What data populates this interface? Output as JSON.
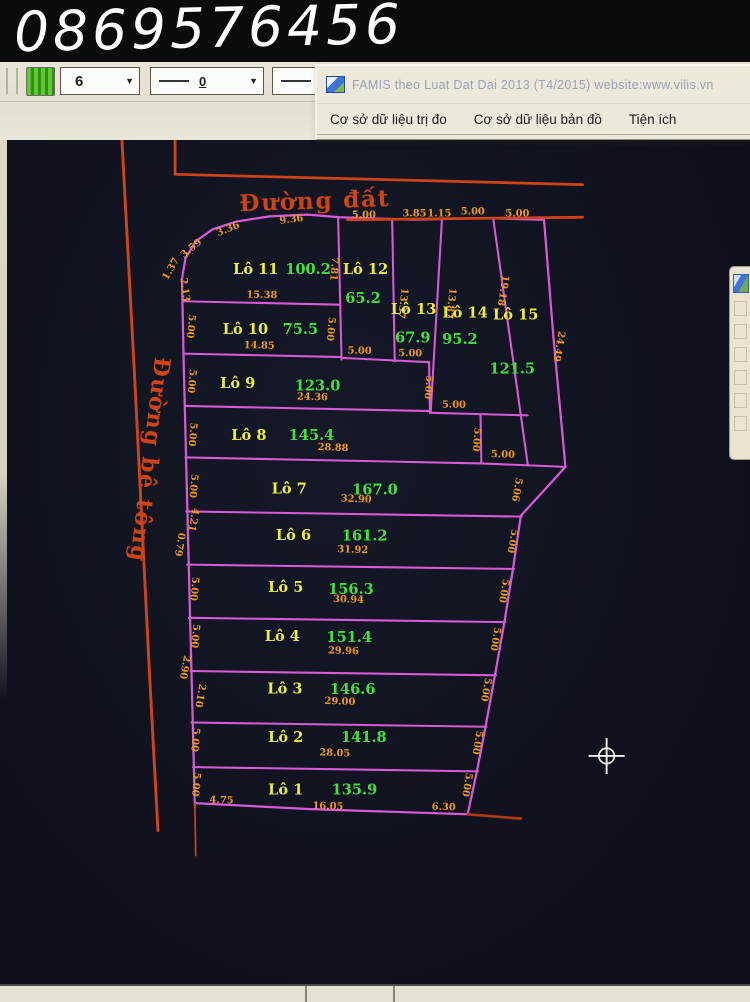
{
  "overlay": {
    "phone": "0869576456"
  },
  "toolbar": {
    "layer_value": "6",
    "line1_value": "0",
    "line2_value": "0",
    "dropdown_arrow": "▼",
    "info_icon_glyph": "i"
  },
  "famis": {
    "title": "FAMIS theo Luat Dat Dai 2013 (T4/2015)   website:www.vilis.vn",
    "menus": [
      "Cơ sở dữ liệu trị đo",
      "Cơ sở dữ liệu bản đồ",
      "Tiện ích"
    ]
  },
  "colors": {
    "magenta": "#d85ad8",
    "road": "#cf4417",
    "road_dark": "#b03a12",
    "dim": "#ef9b16",
    "lot_label": "#ecec3a",
    "area": "#41e23c",
    "cursor": "#f2f2e8",
    "canvas_bg": "#10131f"
  },
  "map": {
    "roads": [
      {
        "name": "Đường đất",
        "x": 305,
        "y": 220,
        "rot": -2,
        "size": 27
      },
      {
        "name": "Đường bê tông",
        "x": 104,
        "y": 512,
        "rot": 97,
        "size": 26
      }
    ],
    "lots": [
      {
        "label": "Lô 1",
        "x": 271,
        "y": 903,
        "area": "135.9",
        "ax": 351,
        "ay": 903
      },
      {
        "label": "Lô 2",
        "x": 271,
        "y": 842,
        "area": "141.8",
        "ax": 362,
        "ay": 842
      },
      {
        "label": "Lô 3",
        "x": 270,
        "y": 785,
        "area": "146.6",
        "ax": 349,
        "ay": 786
      },
      {
        "label": "Lô 4",
        "x": 267,
        "y": 724,
        "area": "151.4",
        "ax": 345,
        "ay": 725
      },
      {
        "label": "Lô 5",
        "x": 271,
        "y": 667,
        "area": "156.3",
        "ax": 347,
        "ay": 669
      },
      {
        "label": "Lô 6",
        "x": 280,
        "y": 606,
        "area": "161.2",
        "ax": 363,
        "ay": 607
      },
      {
        "label": "Lô 7",
        "x": 275,
        "y": 552,
        "area": "167.0",
        "ax": 375,
        "ay": 553
      },
      {
        "label": "Lô 8",
        "x": 228,
        "y": 490,
        "area": "145.4",
        "ax": 301,
        "ay": 490
      },
      {
        "label": "Lô 9",
        "x": 215,
        "y": 429,
        "area": "123.0",
        "ax": 308,
        "ay": 432
      },
      {
        "label": "Lô 10",
        "x": 224,
        "y": 366,
        "area": "75.5",
        "ax": 288,
        "ay": 366
      },
      {
        "label": "Lô 11",
        "x": 236,
        "y": 296,
        "area": "100.2",
        "ax": 297,
        "ay": 296
      },
      {
        "label": "Lô 12",
        "x": 364,
        "y": 296,
        "area": "65.2",
        "ax": 361,
        "ay": 330
      },
      {
        "label": "Lô 13",
        "x": 420,
        "y": 343,
        "area": "67.9",
        "ax": 419,
        "ay": 376
      },
      {
        "label": "Lô 14",
        "x": 480,
        "y": 347,
        "area": "95.2",
        "ax": 474,
        "ay": 378
      },
      {
        "label": "Lô 15",
        "x": 539,
        "y": 349,
        "area": "121.5",
        "ax": 535,
        "ay": 412
      }
    ],
    "dimensions": [
      {
        "t": "3.36",
        "x": 205,
        "y": 247,
        "r": -22
      },
      {
        "t": "3.59",
        "x": 163,
        "y": 269,
        "r": -40
      },
      {
        "t": "1.37",
        "x": 140,
        "y": 292,
        "r": -60
      },
      {
        "t": "2.13",
        "x": 150,
        "y": 315,
        "r": 82
      },
      {
        "t": "9.36",
        "x": 278,
        "y": 236,
        "r": -7
      },
      {
        "t": "5.00",
        "x": 362,
        "y": 231,
        "r": 0
      },
      {
        "t": "3.85",
        "x": 421,
        "y": 229,
        "r": 0
      },
      {
        "t": "1.15",
        "x": 450,
        "y": 229,
        "r": 0
      },
      {
        "t": "5.00",
        "x": 489,
        "y": 227,
        "r": 0
      },
      {
        "t": "5.00",
        "x": 541,
        "y": 229,
        "r": 0
      },
      {
        "t": "7.81",
        "x": 324,
        "y": 290,
        "r": 95
      },
      {
        "t": "13.37",
        "x": 404,
        "y": 330,
        "r": 97
      },
      {
        "t": "13.87",
        "x": 460,
        "y": 330,
        "r": 97
      },
      {
        "t": "19.18",
        "x": 521,
        "y": 315,
        "r": 99
      },
      {
        "t": "24.49",
        "x": 586,
        "y": 380,
        "r": 100
      },
      {
        "t": "5.00",
        "x": 320,
        "y": 360,
        "r": 95
      },
      {
        "t": "5.00",
        "x": 357,
        "y": 389,
        "r": 1
      },
      {
        "t": "5.00",
        "x": 416,
        "y": 392,
        "r": 1
      },
      {
        "t": "5.00",
        "x": 434,
        "y": 428,
        "r": 95
      },
      {
        "t": "5.00",
        "x": 467,
        "y": 452,
        "r": 1
      },
      {
        "t": "5.00",
        "x": 490,
        "y": 489,
        "r": 95
      },
      {
        "t": "5.00",
        "x": 524,
        "y": 510,
        "r": 2
      },
      {
        "t": "5.06",
        "x": 537,
        "y": 547,
        "r": 100
      },
      {
        "t": "5.00",
        "x": 532,
        "y": 607,
        "r": 100
      },
      {
        "t": "5.00",
        "x": 522,
        "y": 665,
        "r": 100
      },
      {
        "t": "5.00",
        "x": 512,
        "y": 721,
        "r": 100
      },
      {
        "t": "5.00",
        "x": 501,
        "y": 780,
        "r": 100
      },
      {
        "t": "5.00",
        "x": 491,
        "y": 842,
        "r": 100
      },
      {
        "t": "5.00",
        "x": 479,
        "y": 891,
        "r": 100
      },
      {
        "t": "6.30",
        "x": 455,
        "y": 921,
        "r": 2
      },
      {
        "t": "5.00",
        "x": 157,
        "y": 357,
        "r": 95
      },
      {
        "t": "5.00",
        "x": 158,
        "y": 421,
        "r": 95
      },
      {
        "t": "5.00",
        "x": 159,
        "y": 483,
        "r": 95
      },
      {
        "t": "5.00",
        "x": 160,
        "y": 543,
        "r": 95
      },
      {
        "t": "4.21",
        "x": 160,
        "y": 582,
        "r": 100
      },
      {
        "t": "0.79",
        "x": 144,
        "y": 611,
        "r": 100
      },
      {
        "t": "5.00",
        "x": 161,
        "y": 663,
        "r": 95
      },
      {
        "t": "5.00",
        "x": 162,
        "y": 718,
        "r": 95
      },
      {
        "t": "2.90",
        "x": 150,
        "y": 754,
        "r": 100
      },
      {
        "t": "2.10",
        "x": 168,
        "y": 787,
        "r": 100
      },
      {
        "t": "5.00",
        "x": 162,
        "y": 839,
        "r": 95
      },
      {
        "t": "5.00",
        "x": 163,
        "y": 891,
        "r": 95
      },
      {
        "t": "4.75",
        "x": 196,
        "y": 913,
        "r": 2
      },
      {
        "t": "15.38",
        "x": 243,
        "y": 324,
        "r": 1
      },
      {
        "t": "14.85",
        "x": 240,
        "y": 383,
        "r": 1
      },
      {
        "t": "24.36",
        "x": 302,
        "y": 443,
        "r": 1
      },
      {
        "t": "28.88",
        "x": 326,
        "y": 502,
        "r": 2
      },
      {
        "t": "32.90",
        "x": 353,
        "y": 562,
        "r": 2
      },
      {
        "t": "31.92",
        "x": 349,
        "y": 621,
        "r": 2
      },
      {
        "t": "30.94",
        "x": 344,
        "y": 679,
        "r": 2
      },
      {
        "t": "29.96",
        "x": 338,
        "y": 739,
        "r": 2
      },
      {
        "t": "29.00",
        "x": 334,
        "y": 798,
        "r": 2
      },
      {
        "t": "28.05",
        "x": 328,
        "y": 858,
        "r": 2
      },
      {
        "t": "16.05",
        "x": 320,
        "y": 920,
        "r": 2
      }
    ],
    "polylines": [
      {
        "name": "parcel-outline-left-top",
        "color": "magenta",
        "w": 2.6,
        "pts": [
          [
            165,
            916
          ],
          [
            158,
            640
          ],
          [
            152,
            400
          ],
          [
            150,
            302
          ],
          [
            154,
            278
          ],
          [
            166,
            258
          ],
          [
            186,
            244
          ],
          [
            214,
            235
          ],
          [
            252,
            229
          ],
          [
            296,
            227
          ],
          [
            334,
            230
          ],
          [
            420,
            233
          ],
          [
            500,
            231
          ],
          [
            572,
            233
          ]
        ]
      },
      {
        "name": "parcel-outline-bottom",
        "color": "magenta",
        "w": 2.6,
        "pts": [
          [
            165,
            913
          ],
          [
            300,
            920
          ],
          [
            483,
            926
          ]
        ]
      },
      {
        "name": "parcel-outline-right",
        "color": "magenta",
        "w": 2.6,
        "pts": [
          [
            572,
            233
          ],
          [
            583,
            370
          ],
          [
            597,
            521
          ],
          [
            545,
            578
          ],
          [
            536,
            639
          ],
          [
            526,
            701
          ],
          [
            515,
            763
          ],
          [
            504,
            823
          ],
          [
            494,
            875
          ],
          [
            483,
            926
          ]
        ]
      },
      {
        "name": "row-line-lot11-bottom",
        "color": "magenta",
        "w": 2.4,
        "pts": [
          [
            151,
            328
          ],
          [
            334,
            332
          ]
        ]
      },
      {
        "name": "row-line-lot10-bottom",
        "color": "magenta",
        "w": 2.4,
        "pts": [
          [
            152,
            389
          ],
          [
            336,
            393
          ]
        ]
      },
      {
        "name": "divider-lot11-lot12",
        "color": "magenta",
        "w": 2.4,
        "pts": [
          [
            332,
            230
          ],
          [
            336,
            396
          ]
        ]
      },
      {
        "name": "divider-lot12-lot13",
        "color": "magenta",
        "w": 2.4,
        "pts": [
          [
            395,
            232
          ],
          [
            398,
            398
          ]
        ]
      },
      {
        "name": "divider-lot13-lot14",
        "color": "magenta",
        "w": 2.4,
        "pts": [
          [
            453,
            233
          ],
          [
            440,
            456
          ]
        ]
      },
      {
        "name": "divider-lot14-lot15",
        "color": "magenta",
        "w": 2.4,
        "pts": [
          [
            513,
            233
          ],
          [
            553,
            518
          ]
        ]
      },
      {
        "name": "lot12-bottom",
        "color": "magenta",
        "w": 2.4,
        "pts": [
          [
            336,
            394
          ],
          [
            398,
            397
          ]
        ]
      },
      {
        "name": "lot13-bottom",
        "color": "magenta",
        "w": 2.4,
        "pts": [
          [
            398,
            397
          ],
          [
            438,
            399
          ]
        ]
      },
      {
        "name": "row9-right-edge",
        "color": "magenta",
        "w": 2.4,
        "pts": [
          [
            438,
            399
          ],
          [
            439,
            456
          ]
        ]
      },
      {
        "name": "row-line-lot9-bottom",
        "color": "magenta",
        "w": 2.4,
        "pts": [
          [
            153,
            450
          ],
          [
            439,
            456
          ]
        ]
      },
      {
        "name": "lot14-bottom-step",
        "color": "magenta",
        "w": 2.4,
        "pts": [
          [
            439,
            458
          ],
          [
            553,
            461
          ]
        ]
      },
      {
        "name": "row8-right-edge",
        "color": "magenta",
        "w": 2.4,
        "pts": [
          [
            498,
            461
          ],
          [
            499,
            517
          ]
        ]
      },
      {
        "name": "row-line-lot8-bottom",
        "color": "magenta",
        "w": 2.4,
        "pts": [
          [
            154,
            510
          ],
          [
            499,
            517
          ]
        ]
      },
      {
        "name": "lot15-bottom-step",
        "color": "magenta",
        "w": 2.4,
        "pts": [
          [
            499,
            517
          ],
          [
            597,
            521
          ]
        ]
      },
      {
        "name": "row-line-lot7-bottom",
        "color": "magenta",
        "w": 2.4,
        "pts": [
          [
            155,
            573
          ],
          [
            546,
            579
          ]
        ]
      },
      {
        "name": "row-line-lot6-bottom",
        "color": "magenta",
        "w": 2.4,
        "pts": [
          [
            156,
            635
          ],
          [
            537,
            640
          ]
        ]
      },
      {
        "name": "row-line-lot5-bottom",
        "color": "magenta",
        "w": 2.4,
        "pts": [
          [
            158,
            697
          ],
          [
            527,
            702
          ]
        ]
      },
      {
        "name": "row-line-lot4-bottom",
        "color": "magenta",
        "w": 2.4,
        "pts": [
          [
            160,
            759
          ],
          [
            516,
            764
          ]
        ]
      },
      {
        "name": "row-line-lot3-bottom",
        "color": "magenta",
        "w": 2.4,
        "pts": [
          [
            161,
            819
          ],
          [
            505,
            824
          ]
        ]
      },
      {
        "name": "row-line-lot2-bottom",
        "color": "magenta",
        "w": 2.4,
        "pts": [
          [
            163,
            871
          ],
          [
            495,
            876
          ]
        ]
      },
      {
        "name": "road-line-top-outer",
        "color": "road",
        "w": 3.2,
        "pts": [
          [
            142,
            140
          ],
          [
            142,
            180
          ],
          [
            300,
            184
          ],
          [
            617,
            192
          ]
        ]
      },
      {
        "name": "road-line-top-inner",
        "color": "road",
        "w": 3.2,
        "pts": [
          [
            343,
            233
          ],
          [
            617,
            230
          ]
        ]
      },
      {
        "name": "road-line-left",
        "color": "road",
        "w": 3.4,
        "pts": [
          [
            80,
            140
          ],
          [
            95,
            420
          ],
          [
            112,
            760
          ],
          [
            122,
            945
          ]
        ]
      },
      {
        "name": "road-line-bottom-tail",
        "color": "road_dark",
        "w": 3,
        "pts": [
          [
            483,
            926
          ],
          [
            545,
            931
          ]
        ]
      },
      {
        "name": "boundary-tail-bottom-left",
        "color": "road",
        "w": 2,
        "pts": [
          [
            165,
            913
          ],
          [
            166,
            974
          ]
        ]
      }
    ],
    "cursor": {
      "x": 645,
      "y": 858
    }
  }
}
